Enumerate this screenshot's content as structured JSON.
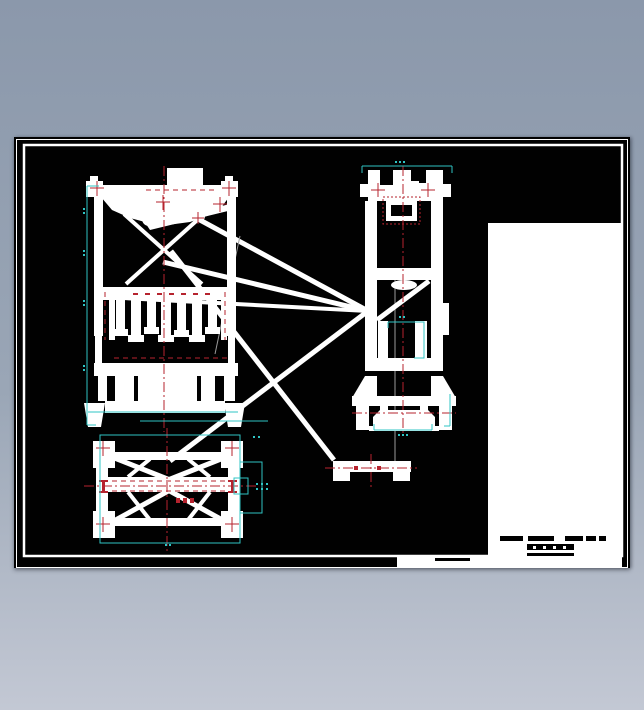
{
  "window": {
    "background_top": "#8b98ab",
    "background_mid": "#9aa6b6",
    "background_bottom": "#c3c8d4"
  },
  "sheet": {
    "paper": "#010101",
    "border": "#ffffff",
    "title_area": "#ffffff"
  },
  "colors": {
    "line": "#ffffff",
    "centerline": "#b6232e",
    "dimension": "#2fc4c4",
    "hidden": "#9a9a9a",
    "text_block": "#000000"
  },
  "views": {
    "front": "front-elevation-view",
    "side": "side-elevation-view",
    "plan": "plan-view",
    "detail": "base-strip-part"
  }
}
